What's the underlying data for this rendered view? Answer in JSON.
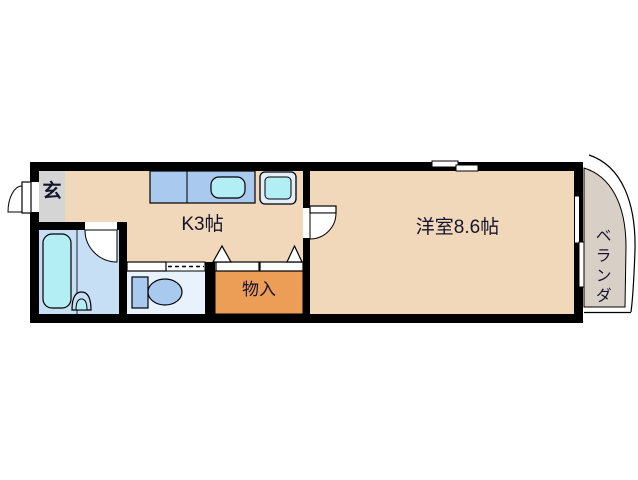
{
  "floorplan": {
    "labels": {
      "entrance": "玄",
      "kitchen": "K3帖",
      "western_room": "洋室8.6帖",
      "storage": "物入",
      "veranda": "ベランダ"
    },
    "rooms": [
      {
        "id": "entrance",
        "label": "玄",
        "meaning": "genkan entrance"
      },
      {
        "id": "kitchen",
        "label": "K3帖",
        "size_jo": 3
      },
      {
        "id": "western_room",
        "label": "洋室8.6帖",
        "size_jo": 8.6
      },
      {
        "id": "storage",
        "label": "物入"
      },
      {
        "id": "veranda",
        "label": "ベランダ"
      },
      {
        "id": "bathroom",
        "label": ""
      },
      {
        "id": "toilet_room",
        "label": ""
      }
    ],
    "fixtures": [
      "entrance-swing-door",
      "kitchen-counter",
      "kitchen-sink",
      "washer-pan",
      "bathtub",
      "bath-washbasin",
      "bathroom-swing-door",
      "toilet",
      "toilet-sliding-door",
      "closet-folding-doors",
      "room-swing-door",
      "sliding-window-top",
      "sliding-window-veranda"
    ],
    "colors": {
      "wall": "#000000",
      "floor": "#f2d8bb",
      "entrance_floor": "#d5d5d5",
      "bathroom": "#c7dff5",
      "toilet_room": "#e7f2fc",
      "fixture_blue": "#a9c9ef",
      "water_cyan": "#b4eef5",
      "storage_orange": "#ec9d56",
      "veranda": "#d8d0c7",
      "background": "#ffffff",
      "text": "#14142e"
    }
  }
}
